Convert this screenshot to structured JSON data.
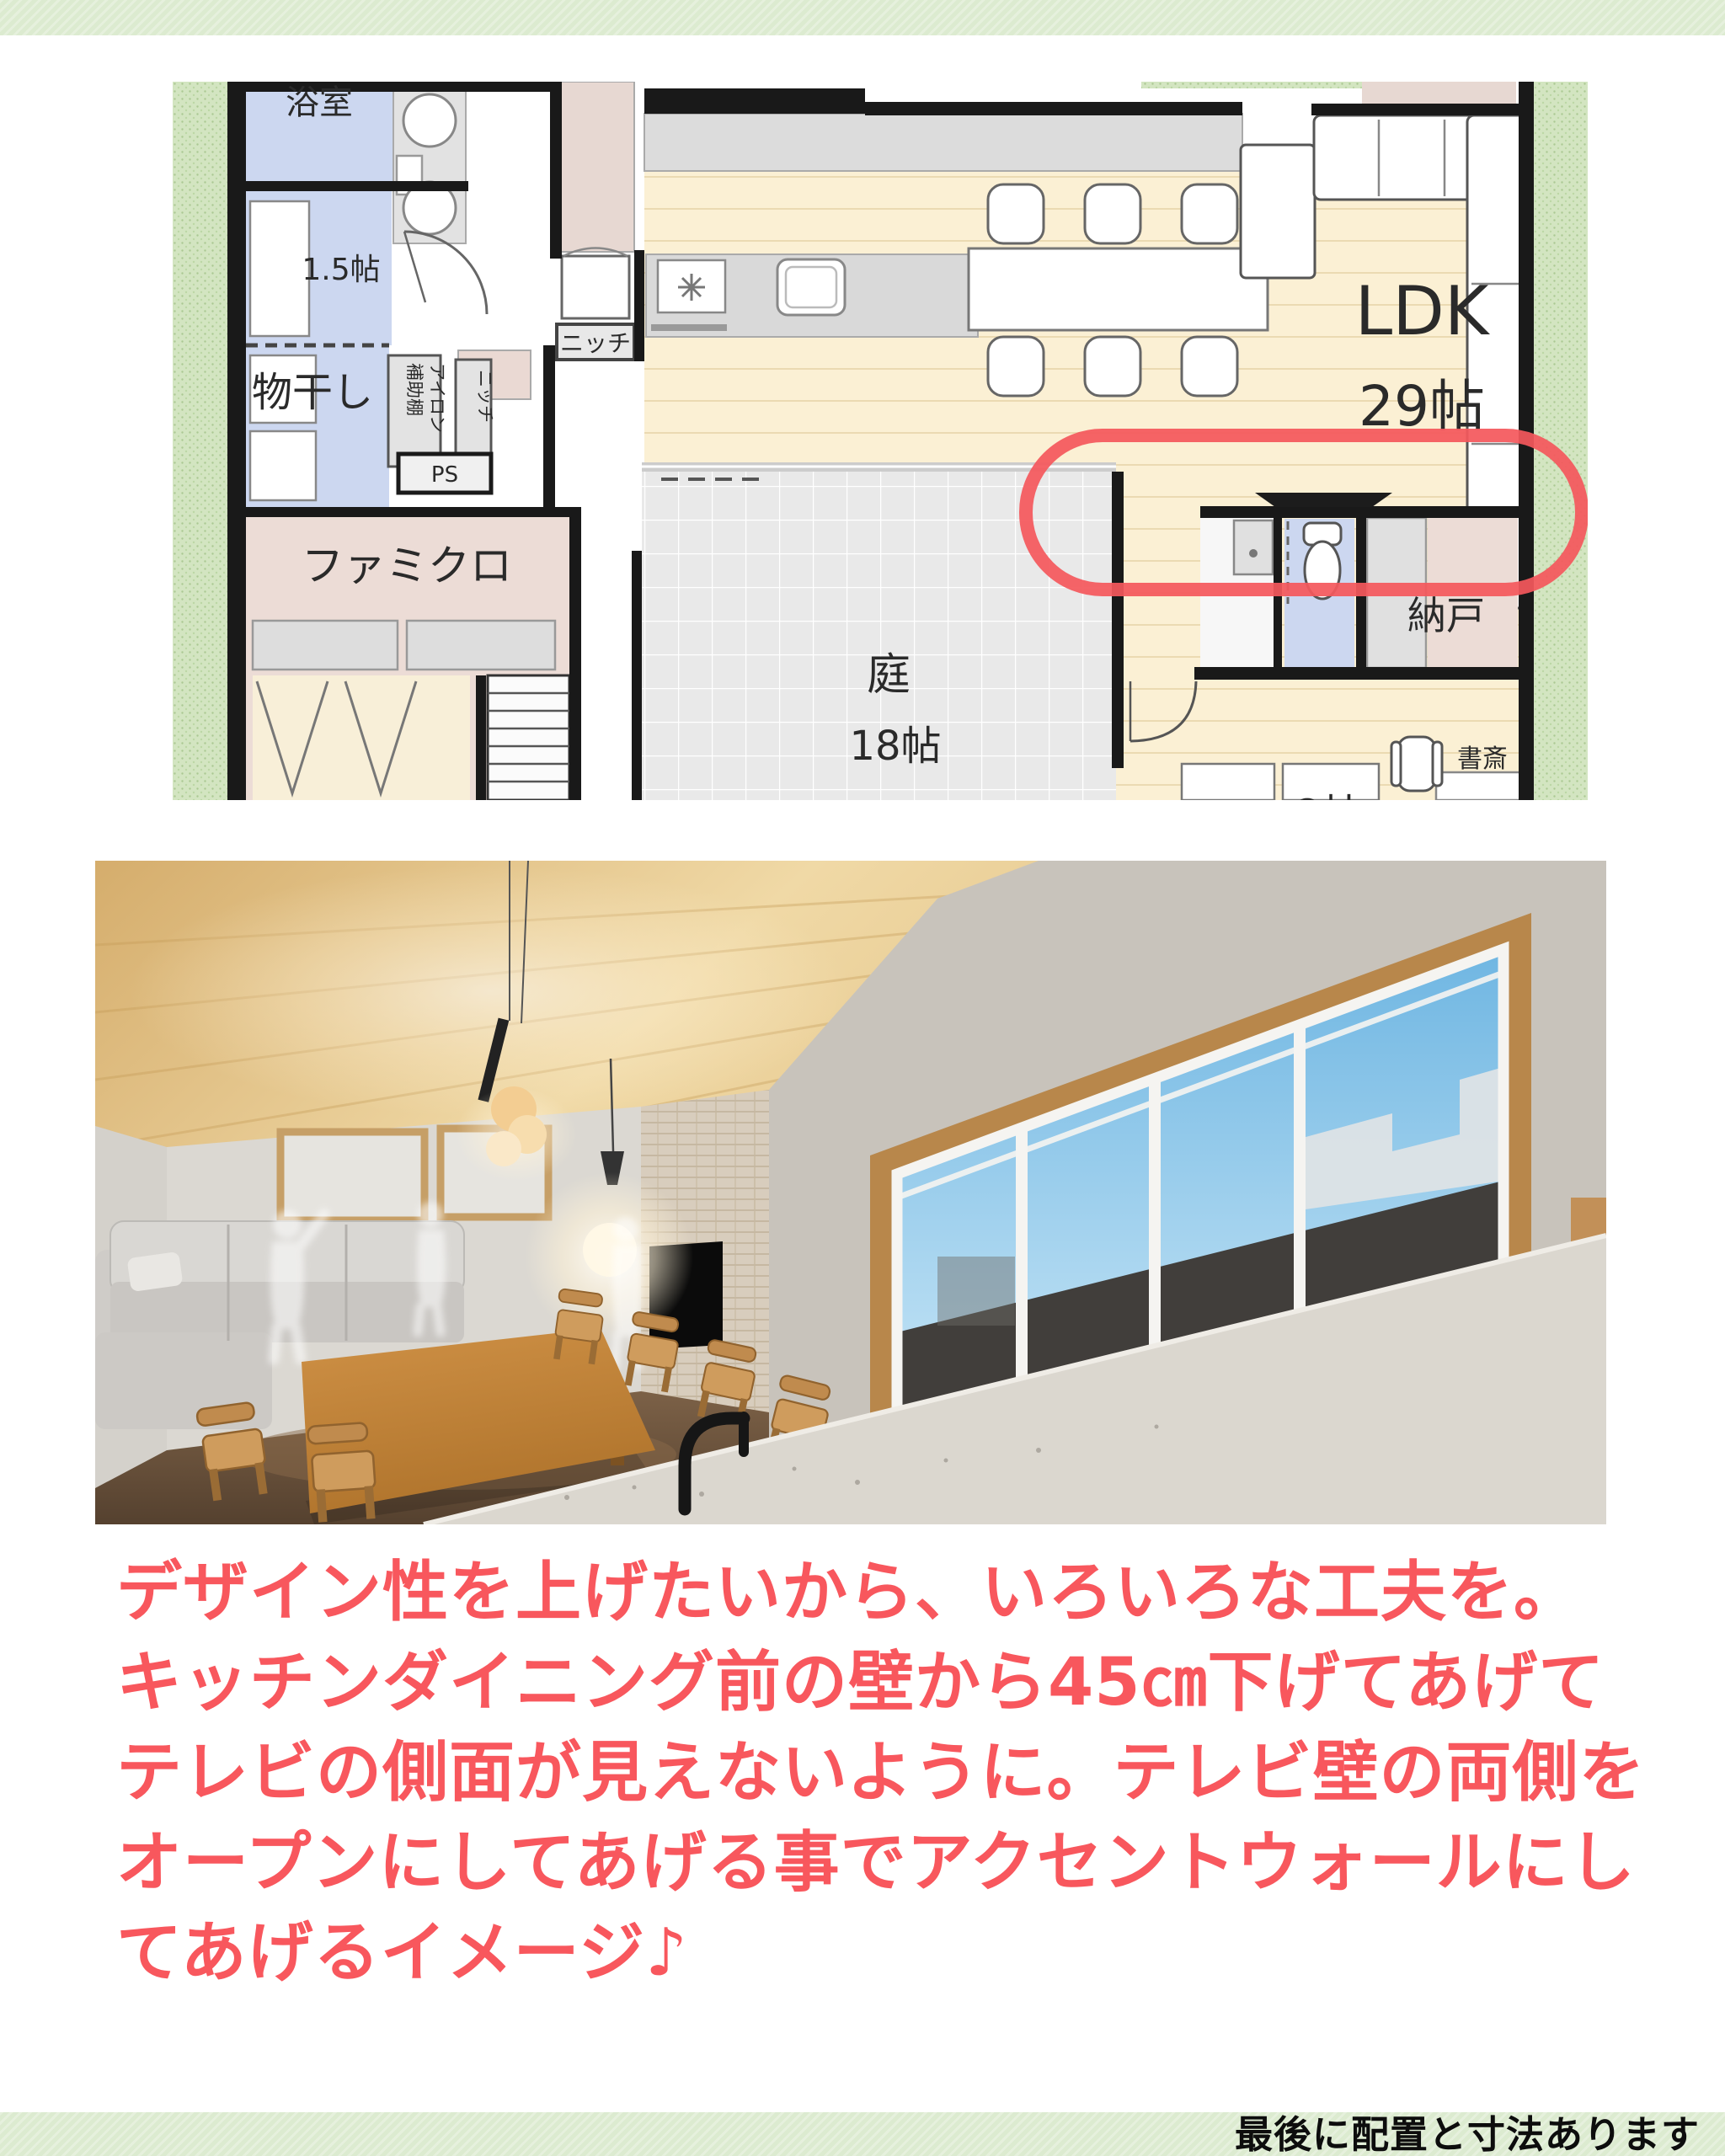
{
  "colors": {
    "banner_green": "#dcebd0",
    "caption_red": "#f8575d",
    "annotation_red": "#f4585c",
    "plan_wood": "#fbf0d4",
    "plan_blue_room": "#ccd7f0",
    "plan_pink_room": "#ecdcd6"
  },
  "floor_plan": {
    "labels": {
      "bathroom": "浴室",
      "utility_size": "1.5帖",
      "drying_room": "物干し",
      "aux_shelf": "補助棚",
      "iron": "アイロン",
      "niche_vertical": "ニッチ",
      "ps": "PS",
      "niche_kitchen": "ニッチ",
      "family_closet": "ファミクロ",
      "ldk": "LDK",
      "ldk_size": "29帖",
      "garden": "庭",
      "garden_size": "18帖",
      "storage": "納戸",
      "study": "書斎",
      "room_partial": "8帖"
    }
  },
  "caption": {
    "lines": [
      "デザイン性を上げたいから、いろいろな工夫を。",
      "キッチンダイニング前の壁から45㎝下げてあげて",
      "テレビの側面が見えないように。テレビ壁の両側を",
      "オープンにしてあげる事でアクセントウォールにし",
      "てあげるイメージ♪"
    ]
  },
  "footer": {
    "banner_text": "最後に配置と寸法あります"
  }
}
